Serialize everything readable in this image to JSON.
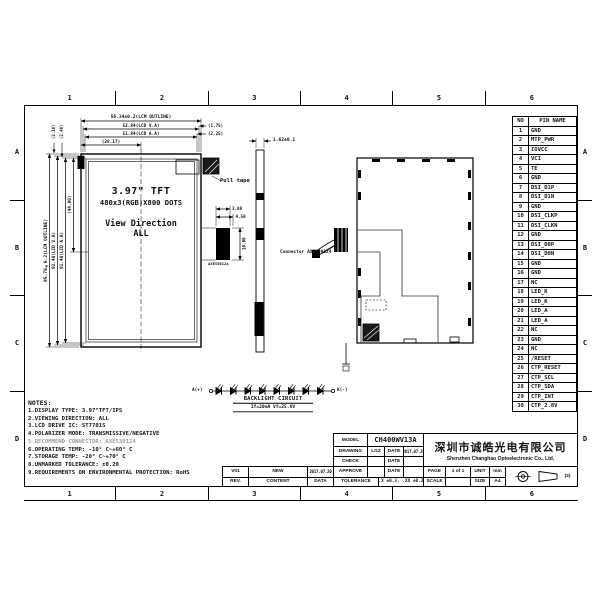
{
  "sheet": {
    "grid_cols": [
      "1",
      "2",
      "3",
      "4",
      "5",
      "6"
    ],
    "grid_rows": [
      "A",
      "B",
      "C",
      "D"
    ]
  },
  "views": {
    "front": {
      "line1": "3.97\" TFT",
      "line2": "480x3(RGB)X800 DOTS",
      "line3": "View Direction",
      "line4": "ALL"
    },
    "labels": {
      "pull_tape": "Pull tape",
      "connector": "Connector AXE530124",
      "connector_small": "AXE530124"
    }
  },
  "dimensions": {
    "h_outline": "56.34±0.2(LCM OUTLINE)",
    "h_va": "52.84(LCD V.A)",
    "h_aa": "51.84(LCD A.A)",
    "h_center": "(28.17)",
    "h_margin_right_top": "(1.75)",
    "h_margin_right_bottom": "(2.25)",
    "v_outline": "95.78±0.2(LCM OUTLINE)",
    "v_va": "92.48(LCD V.A)",
    "v_aa": "91.48(LCD A.A)",
    "v_center": "(44.90)",
    "v_margin_top_1": "(2.10)",
    "v_margin_top_2": "(2.40)",
    "thickness": "1.62±0.1",
    "fpc_width": "3.88",
    "fpc_width2": "4.50",
    "fpc_height": "10.00"
  },
  "backlight": {
    "anode": "A(+)",
    "cathode": "K(-)",
    "title": "BACKLIGHT CIRCUIT",
    "spec": "If=20mA Vf=25.6V",
    "led_count": 8
  },
  "pin_table": {
    "col_no": "NO",
    "col_name": "PIN NAME",
    "rows": [
      {
        "no": "1",
        "name": "GND"
      },
      {
        "no": "2",
        "name": "MTP_PWR"
      },
      {
        "no": "3",
        "name": "IOVCC"
      },
      {
        "no": "4",
        "name": "VCI"
      },
      {
        "no": "5",
        "name": "TE"
      },
      {
        "no": "6",
        "name": "GND"
      },
      {
        "no": "7",
        "name": "DSI_D1P"
      },
      {
        "no": "8",
        "name": "DSI_D1N"
      },
      {
        "no": "9",
        "name": "GND"
      },
      {
        "no": "10",
        "name": "DSI_CLKP"
      },
      {
        "no": "11",
        "name": "DSI_CLKN"
      },
      {
        "no": "12",
        "name": "GND"
      },
      {
        "no": "13",
        "name": "DSI_D0P"
      },
      {
        "no": "14",
        "name": "DSI_D0N"
      },
      {
        "no": "15",
        "name": "GND"
      },
      {
        "no": "16",
        "name": "GND"
      },
      {
        "no": "17",
        "name": "NC"
      },
      {
        "no": "18",
        "name": "LED_K"
      },
      {
        "no": "19",
        "name": "LED_K"
      },
      {
        "no": "20",
        "name": "LED_A"
      },
      {
        "no": "21",
        "name": "LED_A"
      },
      {
        "no": "22",
        "name": "NC"
      },
      {
        "no": "23",
        "name": "GND"
      },
      {
        "no": "24",
        "name": "NC"
      },
      {
        "no": "25",
        "name": "/RESET"
      },
      {
        "no": "26",
        "name": "CTP_RESET"
      },
      {
        "no": "27",
        "name": "CTP_SCL"
      },
      {
        "no": "28",
        "name": "CTP_SDA"
      },
      {
        "no": "29",
        "name": "CTP_INT"
      },
      {
        "no": "30",
        "name": "CTP_2.8V"
      }
    ]
  },
  "notes": {
    "title": "NOTES:",
    "items": [
      {
        "text": "1.DISPLAY TYPE:  3.97\"TFT/IPS",
        "dim": false
      },
      {
        "text": "2.VIEWING DIRECTION: ALL",
        "dim": false
      },
      {
        "text": "3.LCD DRIVE IC: ST7701S",
        "dim": false
      },
      {
        "text": "4.POLARIZER MODE: TRANSMISSIVE/NEGATIVE",
        "dim": false
      },
      {
        "text": "5.RECOMMEND CONNECTOR: AXE530124",
        "dim": true
      },
      {
        "text": "6.OPERATING TEMP: -10° C~+60° C",
        "dim": false
      },
      {
        "text": "7.STORAGE TEMP: -20° C~+70° C",
        "dim": false
      },
      {
        "text": "8.UNMARKED TOLERANCE: ±0.20",
        "dim": false
      },
      {
        "text": "9.REQUIREMENTS ON ENVIRONMENTAL PROTECTION: RoHS",
        "dim": false
      }
    ]
  },
  "title_block": {
    "model_label": "MODEL",
    "model": "CH400WV13A",
    "drawing_label": "DRAWING",
    "drawing_by": "LGZ",
    "date_label": "DATE",
    "drawing_date": "2017.07.20",
    "check_label": "CHECK",
    "approve_label": "APPROVE",
    "tolerance_label": "TOLERANCE",
    "tolerance": ".X ±0.3, .XX ±0.2",
    "page_label": "PAGE",
    "page": "1 of 1",
    "unit_label": "UNIT",
    "unit": "mm",
    "scale_label": "SCALE",
    "size_label": "SIZE",
    "size": "A4",
    "company_cn": "深圳市诚皓光电有限公司",
    "company_en": "Shenzhen Changhao Optoelectronic Co., Ltd.",
    "rev": "V01",
    "rev_content": "NEW",
    "rev_date": "2017.07.20",
    "rev_label": "REV.",
    "content_label": "CONTENT",
    "data_label": "DATA",
    "projection_note": "(3)"
  }
}
